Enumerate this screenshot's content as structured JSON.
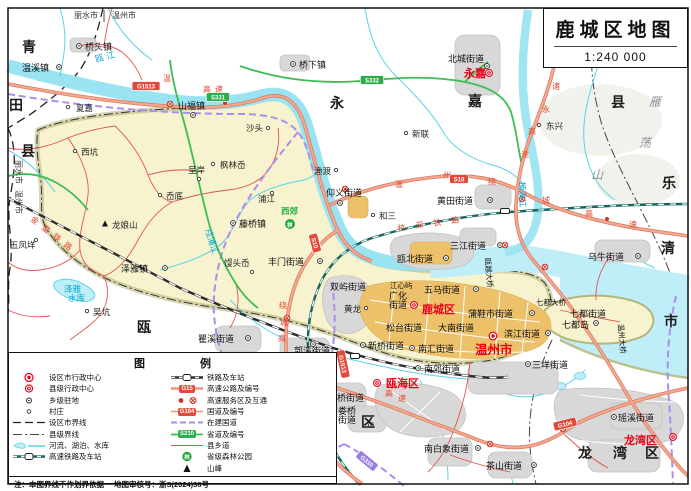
{
  "title": {
    "name": "鹿城区地图",
    "scale": "1:240 000"
  },
  "legend": {
    "title": "图 例",
    "left": [
      "设区市行政中心",
      "县级行政中心",
      "乡级驻地",
      "村庄",
      "设区市界线",
      "县级界线",
      "河流、湖泊、水库",
      "高速铁路及车站"
    ],
    "right": [
      "铁路及车站",
      "高速公路及编号",
      "高速服务区及互通",
      "国道及编号",
      "在建国道",
      "省道及编号",
      "县乡道",
      "省级森林公园",
      "山峰"
    ],
    "badge_examples": {
      "expressway": "G15",
      "national": "G104",
      "provincial": "S210"
    },
    "note": "注：本图界线不作划界依据",
    "approval": "地图审核号：浙S(2024)38号"
  },
  "colors": {
    "seat_red": "#e60012",
    "water": "#5bd2e8",
    "expressway": "#f0957b",
    "provincial_road": "#3dbd55",
    "under_construction": "#ab8df0",
    "district_fill": "#f8f3cf",
    "urban_core": "#ecc169"
  },
  "map": {
    "labels": [
      {
        "t": "青",
        "x": 22,
        "y": 52,
        "c": "rg"
      },
      {
        "t": "田",
        "x": 9,
        "y": 110,
        "c": "rg"
      },
      {
        "t": "县",
        "x": 21,
        "y": 156,
        "c": "rg"
      },
      {
        "t": "永",
        "x": 330,
        "y": 108,
        "c": "rg"
      },
      {
        "t": "嘉",
        "x": 468,
        "y": 106,
        "c": "rg"
      },
      {
        "t": "县",
        "x": 611,
        "y": 107,
        "c": "rg"
      },
      {
        "t": "乐",
        "x": 662,
        "y": 188,
        "c": "rg"
      },
      {
        "t": "清",
        "x": 661,
        "y": 253,
        "c": "rg"
      },
      {
        "t": "市",
        "x": 664,
        "y": 326,
        "c": "rg"
      },
      {
        "t": "瓯",
        "x": 137,
        "y": 332,
        "c": "rg"
      },
      {
        "t": "海",
        "x": 251,
        "y": 386,
        "c": "rg"
      },
      {
        "t": "区",
        "x": 361,
        "y": 427,
        "c": "rg"
      },
      {
        "t": "龙",
        "x": 578,
        "y": 458,
        "c": "rg"
      },
      {
        "t": "湾",
        "x": 613,
        "y": 458,
        "c": "rg"
      },
      {
        "t": "区",
        "x": 645,
        "y": 458,
        "c": "rg"
      },
      {
        "t": "雁",
        "x": 649,
        "y": 106,
        "c": "rg2"
      },
      {
        "t": "荡",
        "x": 639,
        "y": 147,
        "c": "rg2"
      },
      {
        "t": "山",
        "x": 591,
        "y": 179,
        "c": "rg2"
      },
      {
        "t": "永嘉",
        "x": 464,
        "y": 77,
        "c": "red"
      },
      {
        "t": "鹿城区",
        "x": 422,
        "y": 313,
        "c": "red"
      },
      {
        "t": "温州市",
        "x": 475,
        "y": 354,
        "c": "wz"
      },
      {
        "t": "瓯海区",
        "x": 386,
        "y": 387,
        "c": "red"
      },
      {
        "t": "龙湾区",
        "x": 624,
        "y": 444,
        "c": "red"
      },
      {
        "t": "丽水市",
        "x": 74,
        "y": 18,
        "c": "bd"
      },
      {
        "t": "温州市",
        "x": 112,
        "y": 18,
        "c": "bd"
      },
      {
        "t": "丽水市",
        "x": 16,
        "y": 160,
        "c": "bd",
        "r": 90
      },
      {
        "t": "温州市",
        "x": 16,
        "y": 190,
        "c": "bd",
        "r": 90
      },
      {
        "t": "温溪镇",
        "x": 22,
        "y": 71,
        "c": "st"
      },
      {
        "t": "桥头镇",
        "x": 85,
        "y": 50,
        "c": "st"
      },
      {
        "t": "桥下镇",
        "x": 299,
        "y": 68,
        "c": "st"
      },
      {
        "t": "北城街道",
        "x": 448,
        "y": 62,
        "c": "st"
      },
      {
        "t": "夏嘉",
        "x": 76,
        "y": 111,
        "c": "v"
      },
      {
        "t": "山福镇",
        "x": 178,
        "y": 109,
        "c": "st"
      },
      {
        "t": "沙头",
        "x": 246,
        "y": 131,
        "c": "v"
      },
      {
        "t": "新联",
        "x": 412,
        "y": 137,
        "c": "v"
      },
      {
        "t": "东兴",
        "x": 546,
        "y": 129,
        "c": "v"
      },
      {
        "t": "西坑",
        "x": 81,
        "y": 155,
        "c": "v"
      },
      {
        "t": "枫林岙",
        "x": 220,
        "y": 168,
        "c": "v"
      },
      {
        "t": "呈岸",
        "x": 188,
        "y": 173,
        "c": "v"
      },
      {
        "t": "岙底",
        "x": 166,
        "y": 199,
        "c": "v"
      },
      {
        "t": "浦江",
        "x": 258,
        "y": 202,
        "c": "v"
      },
      {
        "t": "渔渡",
        "x": 314,
        "y": 174,
        "c": "v"
      },
      {
        "t": "仰义街道",
        "x": 326,
        "y": 196,
        "c": "st"
      },
      {
        "t": "和三",
        "x": 379,
        "y": 219,
        "c": "v"
      },
      {
        "t": "黄田街道",
        "x": 437,
        "y": 204,
        "c": "st"
      },
      {
        "t": "三江街道",
        "x": 450,
        "y": 249,
        "c": "st"
      },
      {
        "t": "瓯北街道",
        "x": 397,
        "y": 262,
        "c": "st"
      },
      {
        "t": "乌牛街道",
        "x": 588,
        "y": 260,
        "c": "st"
      },
      {
        "t": "藤桥镇",
        "x": 239,
        "y": 227,
        "c": "st"
      },
      {
        "t": "泽雅镇",
        "x": 121,
        "y": 272,
        "c": "st"
      },
      {
        "t": "馒头岙",
        "x": 224,
        "y": 266,
        "c": "v"
      },
      {
        "t": "丰门街道",
        "x": 268,
        "y": 265,
        "c": "st"
      },
      {
        "t": "五凤垟",
        "x": 10,
        "y": 248,
        "c": "v"
      },
      {
        "t": "吴坑",
        "x": 93,
        "y": 315,
        "c": "v"
      },
      {
        "t": "瞿溪街道",
        "x": 198,
        "y": 342,
        "c": "st"
      },
      {
        "t": "郭溪街道",
        "x": 294,
        "y": 354,
        "c": "st"
      },
      {
        "t": "双屿街道",
        "x": 330,
        "y": 290,
        "c": "st"
      },
      {
        "t": "广化",
        "x": 389,
        "y": 299,
        "c": "st"
      },
      {
        "t": "街道",
        "x": 389,
        "y": 308,
        "c": "st"
      },
      {
        "t": "五马街道",
        "x": 424,
        "y": 293,
        "c": "st"
      },
      {
        "t": "蒲鞋市街道",
        "x": 468,
        "y": 317,
        "c": "st"
      },
      {
        "t": "松台街道",
        "x": 386,
        "y": 331,
        "c": "st"
      },
      {
        "t": "大南街道",
        "x": 438,
        "y": 331,
        "c": "st"
      },
      {
        "t": "滨江街道",
        "x": 504,
        "y": 337,
        "c": "st"
      },
      {
        "t": "新桥街道",
        "x": 368,
        "y": 349,
        "c": "st"
      },
      {
        "t": "南汇街道",
        "x": 418,
        "y": 352,
        "c": "st"
      },
      {
        "t": "南郊街道",
        "x": 424,
        "y": 372,
        "c": "st"
      },
      {
        "t": "三垟街道",
        "x": 532,
        "y": 368,
        "c": "st"
      },
      {
        "t": "七都街道",
        "x": 570,
        "y": 317,
        "c": "st"
      },
      {
        "t": "七都岛",
        "x": 562,
        "y": 328,
        "c": "st"
      },
      {
        "t": "潘桥街道",
        "x": 328,
        "y": 401,
        "c": "st"
      },
      {
        "t": "娄桥",
        "x": 338,
        "y": 414,
        "c": "st"
      },
      {
        "t": "街道",
        "x": 338,
        "y": 423,
        "c": "st"
      },
      {
        "t": "黄龙",
        "x": 344,
        "y": 312,
        "c": "v"
      },
      {
        "t": "南白象街道",
        "x": 424,
        "y": 452,
        "c": "st"
      },
      {
        "t": "茶山街道",
        "x": 486,
        "y": 469,
        "c": "st"
      },
      {
        "t": "瑶溪街道",
        "x": 618,
        "y": 421,
        "c": "st"
      },
      {
        "t": "龙娘山",
        "x": 112,
        "y": 228,
        "c": "v"
      },
      {
        "t": "西郊",
        "x": 281,
        "y": 214,
        "c": "fo"
      },
      {
        "t": "林",
        "x": 287,
        "y": 227,
        "c": "fog"
      },
      {
        "t": "瓯江",
        "x": 96,
        "y": 62,
        "c": "wa",
        "r": -14,
        "s": 3
      },
      {
        "t": "楠溪江",
        "x": 519,
        "y": 182,
        "c": "wa",
        "r": 88
      },
      {
        "t": "泽雅",
        "x": 64,
        "y": 292,
        "c": "wa"
      },
      {
        "t": "水库",
        "x": 68,
        "y": 301,
        "c": "wa"
      },
      {
        "t": "戍浦江",
        "x": 205,
        "y": 230,
        "c": "wa",
        "r": 72
      },
      {
        "t": "七都大桥",
        "x": 536,
        "y": 305,
        "c": "br"
      },
      {
        "t": "温州大桥",
        "x": 618,
        "y": 324,
        "c": "br",
        "r": 85
      },
      {
        "t": "瓯越大桥",
        "x": 485,
        "y": 258,
        "c": "br",
        "r": 85
      },
      {
        "t": "江心屿",
        "x": 390,
        "y": 288,
        "c": "br"
      },
      {
        "t": "金温铁路",
        "x": 30,
        "y": 220,
        "c": "rl",
        "r": 38,
        "s": 6
      },
      {
        "t": "杭深铁路",
        "x": 398,
        "y": 231,
        "c": "rl",
        "r": -8,
        "s": 10
      },
      {
        "t": "温",
        "x": 163,
        "y": 81,
        "c": "rr"
      },
      {
        "t": "高",
        "x": 203,
        "y": 92,
        "c": "rr"
      },
      {
        "t": "速",
        "x": 215,
        "y": 92,
        "c": "rr"
      },
      {
        "t": "温",
        "x": 395,
        "y": 187,
        "c": "rr"
      },
      {
        "t": "州",
        "x": 443,
        "y": 178,
        "c": "rr"
      },
      {
        "t": "绕",
        "x": 488,
        "y": 184,
        "c": "rr"
      },
      {
        "t": "城",
        "x": 542,
        "y": 203,
        "c": "rr"
      },
      {
        "t": "高",
        "x": 585,
        "y": 216,
        "c": "rr"
      },
      {
        "t": "速",
        "x": 629,
        "y": 227,
        "c": "rr"
      },
      {
        "t": "绕",
        "x": 279,
        "y": 308,
        "c": "rr"
      },
      {
        "t": "城",
        "x": 280,
        "y": 325,
        "c": "rr"
      },
      {
        "t": "高",
        "x": 278,
        "y": 341,
        "c": "rr"
      },
      {
        "t": "速",
        "x": 267,
        "y": 360,
        "c": "rr"
      },
      {
        "t": "诸",
        "x": 552,
        "y": 89,
        "c": "rr"
      },
      {
        "t": "永",
        "x": 542,
        "y": 112,
        "c": "rr"
      },
      {
        "t": "高",
        "x": 528,
        "y": 134,
        "c": "rr"
      },
      {
        "t": "速",
        "x": 521,
        "y": 157,
        "c": "rr"
      },
      {
        "t": "高",
        "x": 385,
        "y": 396,
        "c": "rr"
      },
      {
        "t": "速",
        "x": 398,
        "y": 401,
        "c": "rr"
      },
      {
        "t": "G1513",
        "x": 146,
        "y": 86,
        "c": "bdg-r"
      },
      {
        "t": "S331",
        "x": 218,
        "y": 97,
        "c": "bdg-g"
      },
      {
        "t": "S332",
        "x": 372,
        "y": 80,
        "c": "bdg-g"
      },
      {
        "t": "S10",
        "x": 459,
        "y": 179,
        "c": "bdg-r"
      },
      {
        "t": "S10",
        "x": 315,
        "y": 243,
        "c": "bdg-r",
        "r": 75
      },
      {
        "t": "G1513",
        "x": 343,
        "y": 364,
        "c": "bdg-r",
        "r": 78
      },
      {
        "t": "G330",
        "x": 367,
        "y": 461,
        "c": "bdg-p",
        "r": 40
      },
      {
        "t": "G104",
        "x": 565,
        "y": 424,
        "c": "bdg-r",
        "r": -14
      }
    ],
    "symbols": [
      {
        "ty": "town",
        "x": 59,
        "y": 67
      },
      {
        "ty": "town",
        "x": 79,
        "y": 46
      },
      {
        "ty": "town",
        "x": 293,
        "y": 64
      },
      {
        "ty": "town",
        "x": 487,
        "y": 66
      },
      {
        "ty": "county",
        "x": 489,
        "y": 73
      },
      {
        "ty": "village",
        "x": 68,
        "y": 107
      },
      {
        "ty": "town",
        "x": 193,
        "y": 115
      },
      {
        "ty": "village",
        "x": 268,
        "y": 128
      },
      {
        "ty": "village",
        "x": 406,
        "y": 133
      },
      {
        "ty": "village",
        "x": 539,
        "y": 125
      },
      {
        "ty": "village",
        "x": 75,
        "y": 151
      },
      {
        "ty": "village",
        "x": 213,
        "y": 164
      },
      {
        "ty": "village",
        "x": 199,
        "y": 179
      },
      {
        "ty": "village",
        "x": 160,
        "y": 195
      },
      {
        "ty": "village",
        "x": 272,
        "y": 193
      },
      {
        "ty": "village",
        "x": 336,
        "y": 170
      },
      {
        "ty": "town",
        "x": 340,
        "y": 203
      },
      {
        "ty": "village",
        "x": 373,
        "y": 215
      },
      {
        "ty": "town",
        "x": 490,
        "y": 200
      },
      {
        "ty": "town",
        "x": 500,
        "y": 245
      },
      {
        "ty": "town",
        "x": 446,
        "y": 258
      },
      {
        "ty": "town",
        "x": 638,
        "y": 256
      },
      {
        "ty": "town",
        "x": 233,
        "y": 223
      },
      {
        "ty": "town",
        "x": 165,
        "y": 268
      },
      {
        "ty": "village",
        "x": 252,
        "y": 272
      },
      {
        "ty": "town",
        "x": 320,
        "y": 261
      },
      {
        "ty": "village",
        "x": 36,
        "y": 240
      },
      {
        "ty": "village",
        "x": 87,
        "y": 311
      },
      {
        "ty": "town",
        "x": 248,
        "y": 338
      },
      {
        "ty": "town",
        "x": 313,
        "y": 344
      },
      {
        "ty": "town",
        "x": 476,
        "y": 289
      },
      {
        "ty": "county",
        "x": 414,
        "y": 305
      },
      {
        "ty": "town",
        "x": 532,
        "y": 313
      },
      {
        "ty": "town",
        "x": 548,
        "y": 333
      },
      {
        "ty": "city",
        "x": 493,
        "y": 336
      },
      {
        "ty": "town",
        "x": 412,
        "y": 348
      },
      {
        "ty": "town",
        "x": 363,
        "y": 345
      },
      {
        "ty": "town",
        "x": 418,
        "y": 368
      },
      {
        "ty": "town",
        "x": 528,
        "y": 364
      },
      {
        "ty": "town",
        "x": 596,
        "y": 323
      },
      {
        "ty": "county",
        "x": 377,
        "y": 383
      },
      {
        "ty": "town",
        "x": 323,
        "y": 397
      },
      {
        "ty": "town",
        "x": 371,
        "y": 425
      },
      {
        "ty": "village",
        "x": 366,
        "y": 308
      },
      {
        "ty": "town",
        "x": 478,
        "y": 448
      },
      {
        "ty": "town",
        "x": 534,
        "y": 465
      },
      {
        "ty": "town",
        "x": 614,
        "y": 417
      },
      {
        "ty": "county",
        "x": 673,
        "y": 437
      },
      {
        "ty": "ix",
        "x": 170,
        "y": 104
      },
      {
        "ty": "ix",
        "x": 345,
        "y": 189
      },
      {
        "ty": "ix",
        "x": 505,
        "y": 245
      },
      {
        "ty": "ix",
        "x": 522,
        "y": 199
      },
      {
        "ty": "ix",
        "x": 287,
        "y": 318
      },
      {
        "ty": "ix",
        "x": 490,
        "y": 444
      },
      {
        "ty": "ix",
        "x": 563,
        "y": 429
      },
      {
        "ty": "ix",
        "x": 545,
        "y": 267
      },
      {
        "ty": "sv",
        "x": 225,
        "y": 103
      },
      {
        "ty": "sv",
        "x": 607,
        "y": 219
      },
      {
        "ty": "stn",
        "x": 505,
        "y": 211
      },
      {
        "ty": "stn",
        "x": 355,
        "y": 356
      },
      {
        "ty": "peak",
        "x": 105,
        "y": 224
      },
      {
        "ty": "forest",
        "x": 290,
        "y": 224
      }
    ]
  }
}
